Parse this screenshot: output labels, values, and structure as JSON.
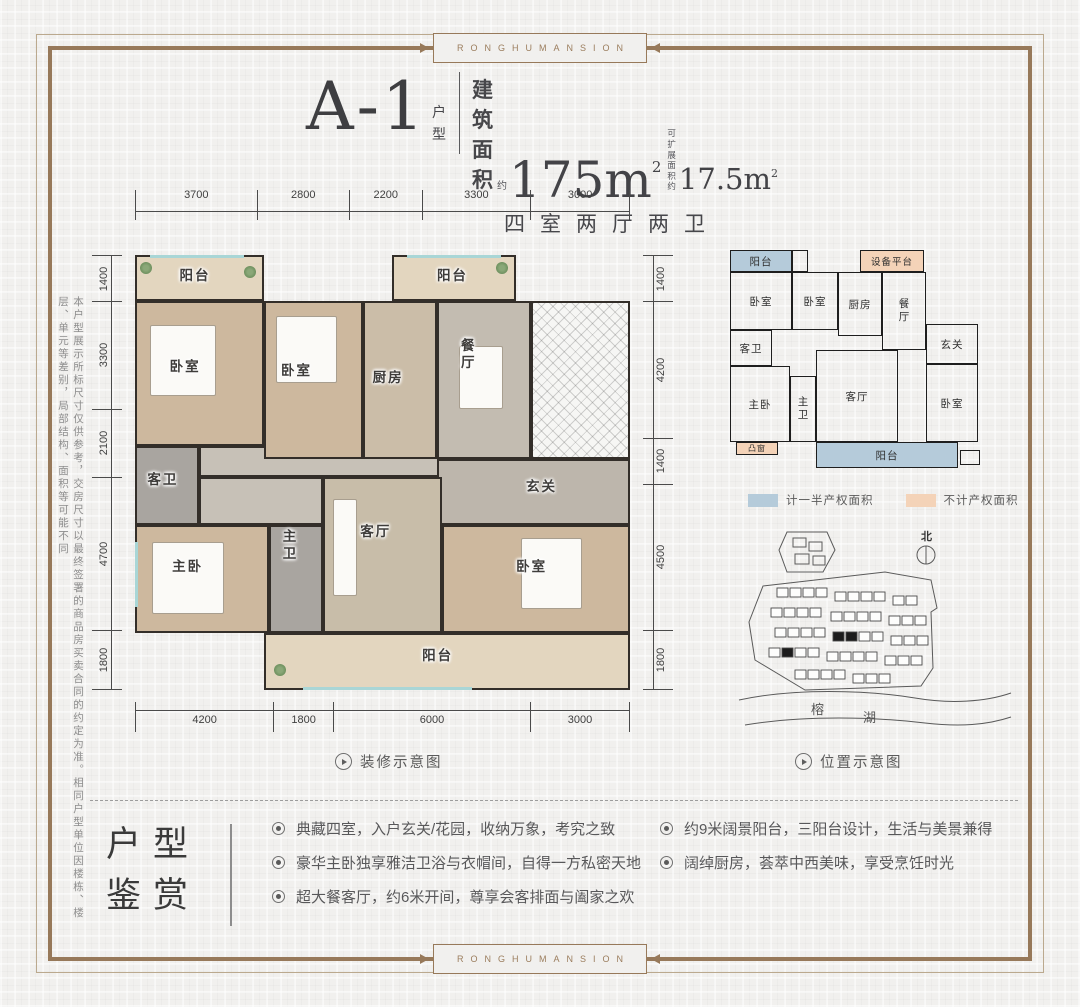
{
  "brand": {
    "top_label": "RONGHUMANSION",
    "bottom_label": "RONGHUMANSION"
  },
  "colors": {
    "frame": "#97795a",
    "wall": "#332e29",
    "legend_half": "#b5cbda",
    "legend_none": "#f4d3b8",
    "window": "#a9d6d6"
  },
  "header": {
    "unit_name": "A-1",
    "unit_type": "户型",
    "area_prefix": "建筑面积",
    "area_approx": "约",
    "area_value": "175m",
    "area_sup": "2",
    "expand_l1": "可扩展",
    "expand_l2": "面积约",
    "expand_value": "17.5m",
    "expand_sup": "2",
    "layout_desc": "四室两厅两卫"
  },
  "side_note": "本户型展示所标尺寸仅供参考，交房尺寸以最终签署的商品房买卖合同的约定为准。相同户型单位因楼栋、楼层、单元等差别，局部结构、面积等可能不同",
  "main_plan": {
    "caption": "装修示意图",
    "dims_top": [
      "3700",
      "2800",
      "2200",
      "3300",
      "3000"
    ],
    "dims_left": [
      "1400",
      "3300",
      "2100",
      "4700",
      "1800"
    ],
    "dims_right": [
      "1400",
      "4200",
      "1400",
      "4500",
      "1800"
    ],
    "dims_bottom": [
      "4200",
      "1800",
      "6000",
      "3000"
    ],
    "rooms": {
      "balcony_tl": "阳台",
      "bedroom_1": "卧室",
      "bedroom_2": "卧室",
      "kitchen": "厨房",
      "dining": "餐厅",
      "balcony_top": "阳台",
      "guest_bath": "客卫",
      "foyer": "玄关",
      "master": "主卧",
      "master_bath": "主卫",
      "living": "客厅",
      "bedroom_3": "卧室",
      "balcony_bottom": "阳台"
    }
  },
  "floor_schematic": {
    "rooms": {
      "balcony_top": "阳台",
      "equipment": "设备平台",
      "bedroom_1": "卧室",
      "bedroom_2": "卧室",
      "kitchen": "厨房",
      "dining": "餐厅",
      "guest_bath": "客卫",
      "foyer": "玄关",
      "master": "主卧",
      "master_bath": "主卫",
      "living": "客厅",
      "bedroom_3": "卧室",
      "balcony_bottom": "阳台",
      "bay_window": "凸窗"
    },
    "legend": [
      {
        "label": "计一半产权面积",
        "color": "#b5cbda"
      },
      {
        "label": "不计产权面积",
        "color": "#f4d3b8"
      }
    ]
  },
  "site_plan": {
    "caption": "位置示意图",
    "north": "北",
    "lake_char1": "榕",
    "lake_char2": "湖"
  },
  "features": {
    "title_l1": "户型",
    "title_l2": "鉴赏",
    "items_left": [
      "典藏四室，入户玄关/花园，收纳万象，考究之致",
      "豪华主卧独享雅洁卫浴与衣帽间，自得一方私密天地",
      "超大餐客厅，约6米开间，尊享会客排面与阖家之欢"
    ],
    "items_right": [
      "约9米阔景阳台，三阳台设计，生活与美景兼得",
      "阔绰厨房，荟萃中西美味，享受烹饪时光"
    ]
  }
}
